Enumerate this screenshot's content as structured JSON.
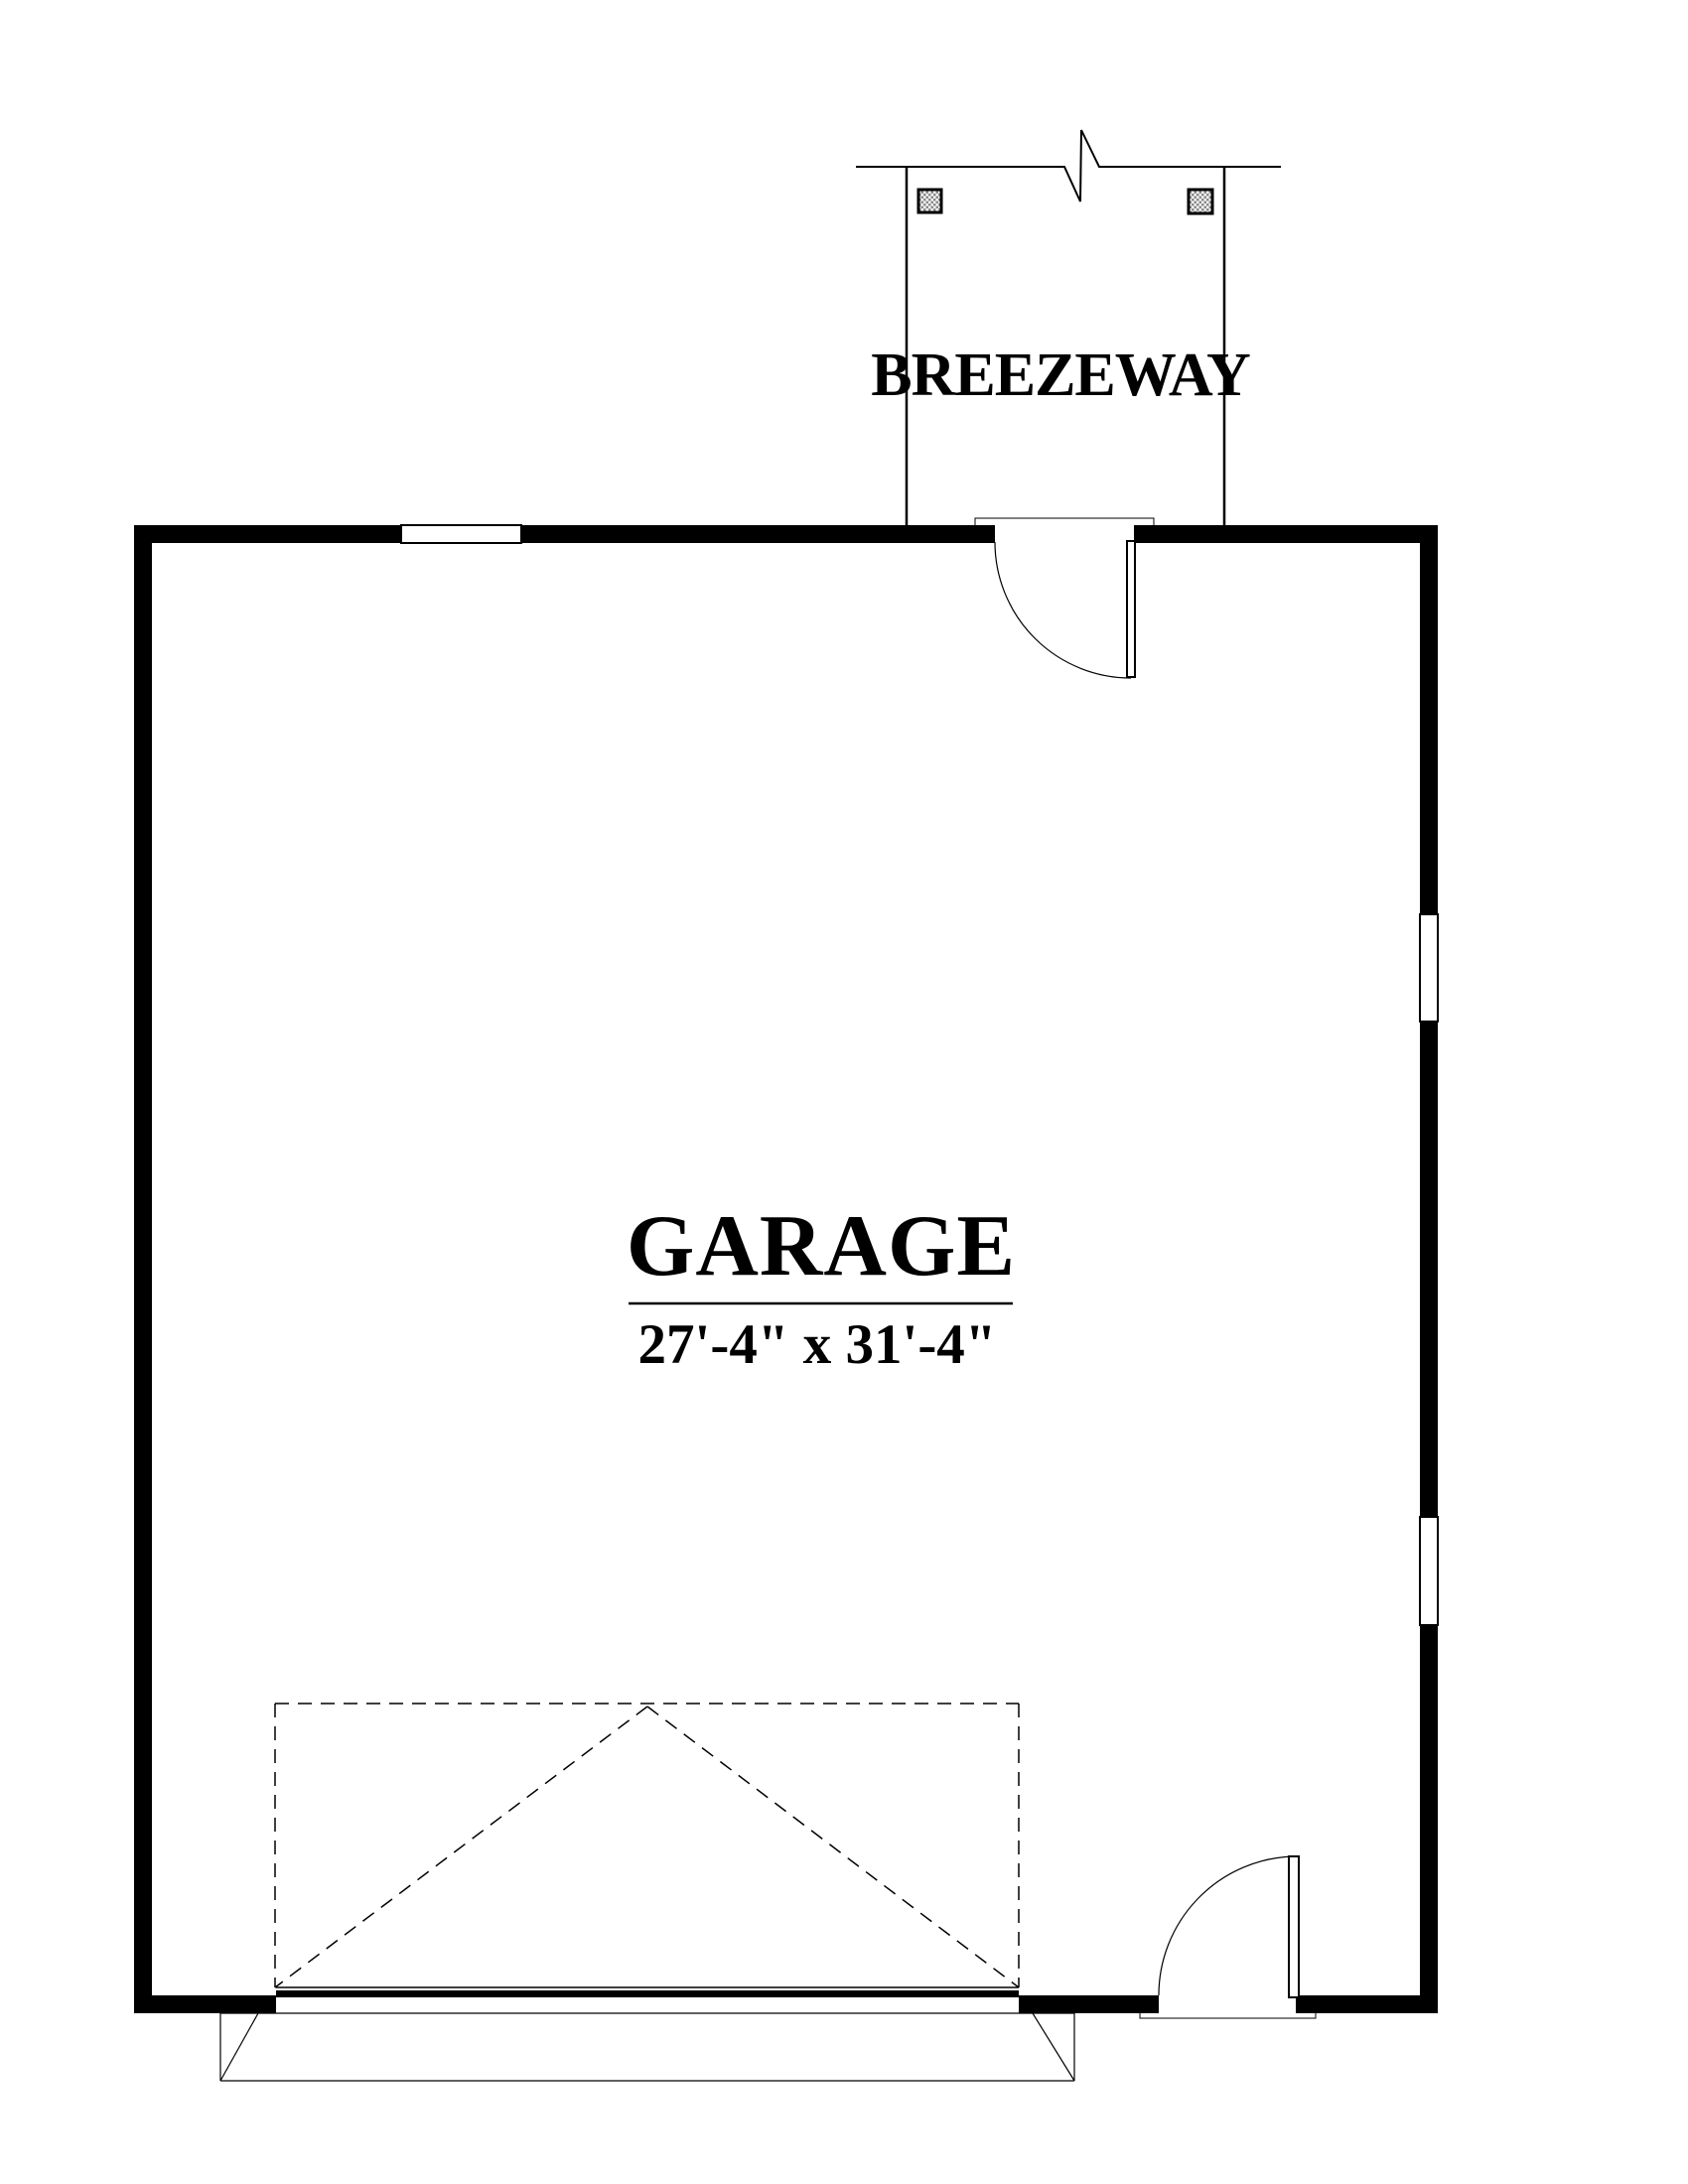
{
  "document": {
    "type": "architectural floor plan",
    "background_color": "#ffffff",
    "line_color": "#000000",
    "hatch_color": "#8a8a8a"
  },
  "labels": {
    "breezeway": "BREEZEWAY",
    "room_name": "GARAGE",
    "room_dimensions": "27'-4\" x 31'-4\""
  }
}
